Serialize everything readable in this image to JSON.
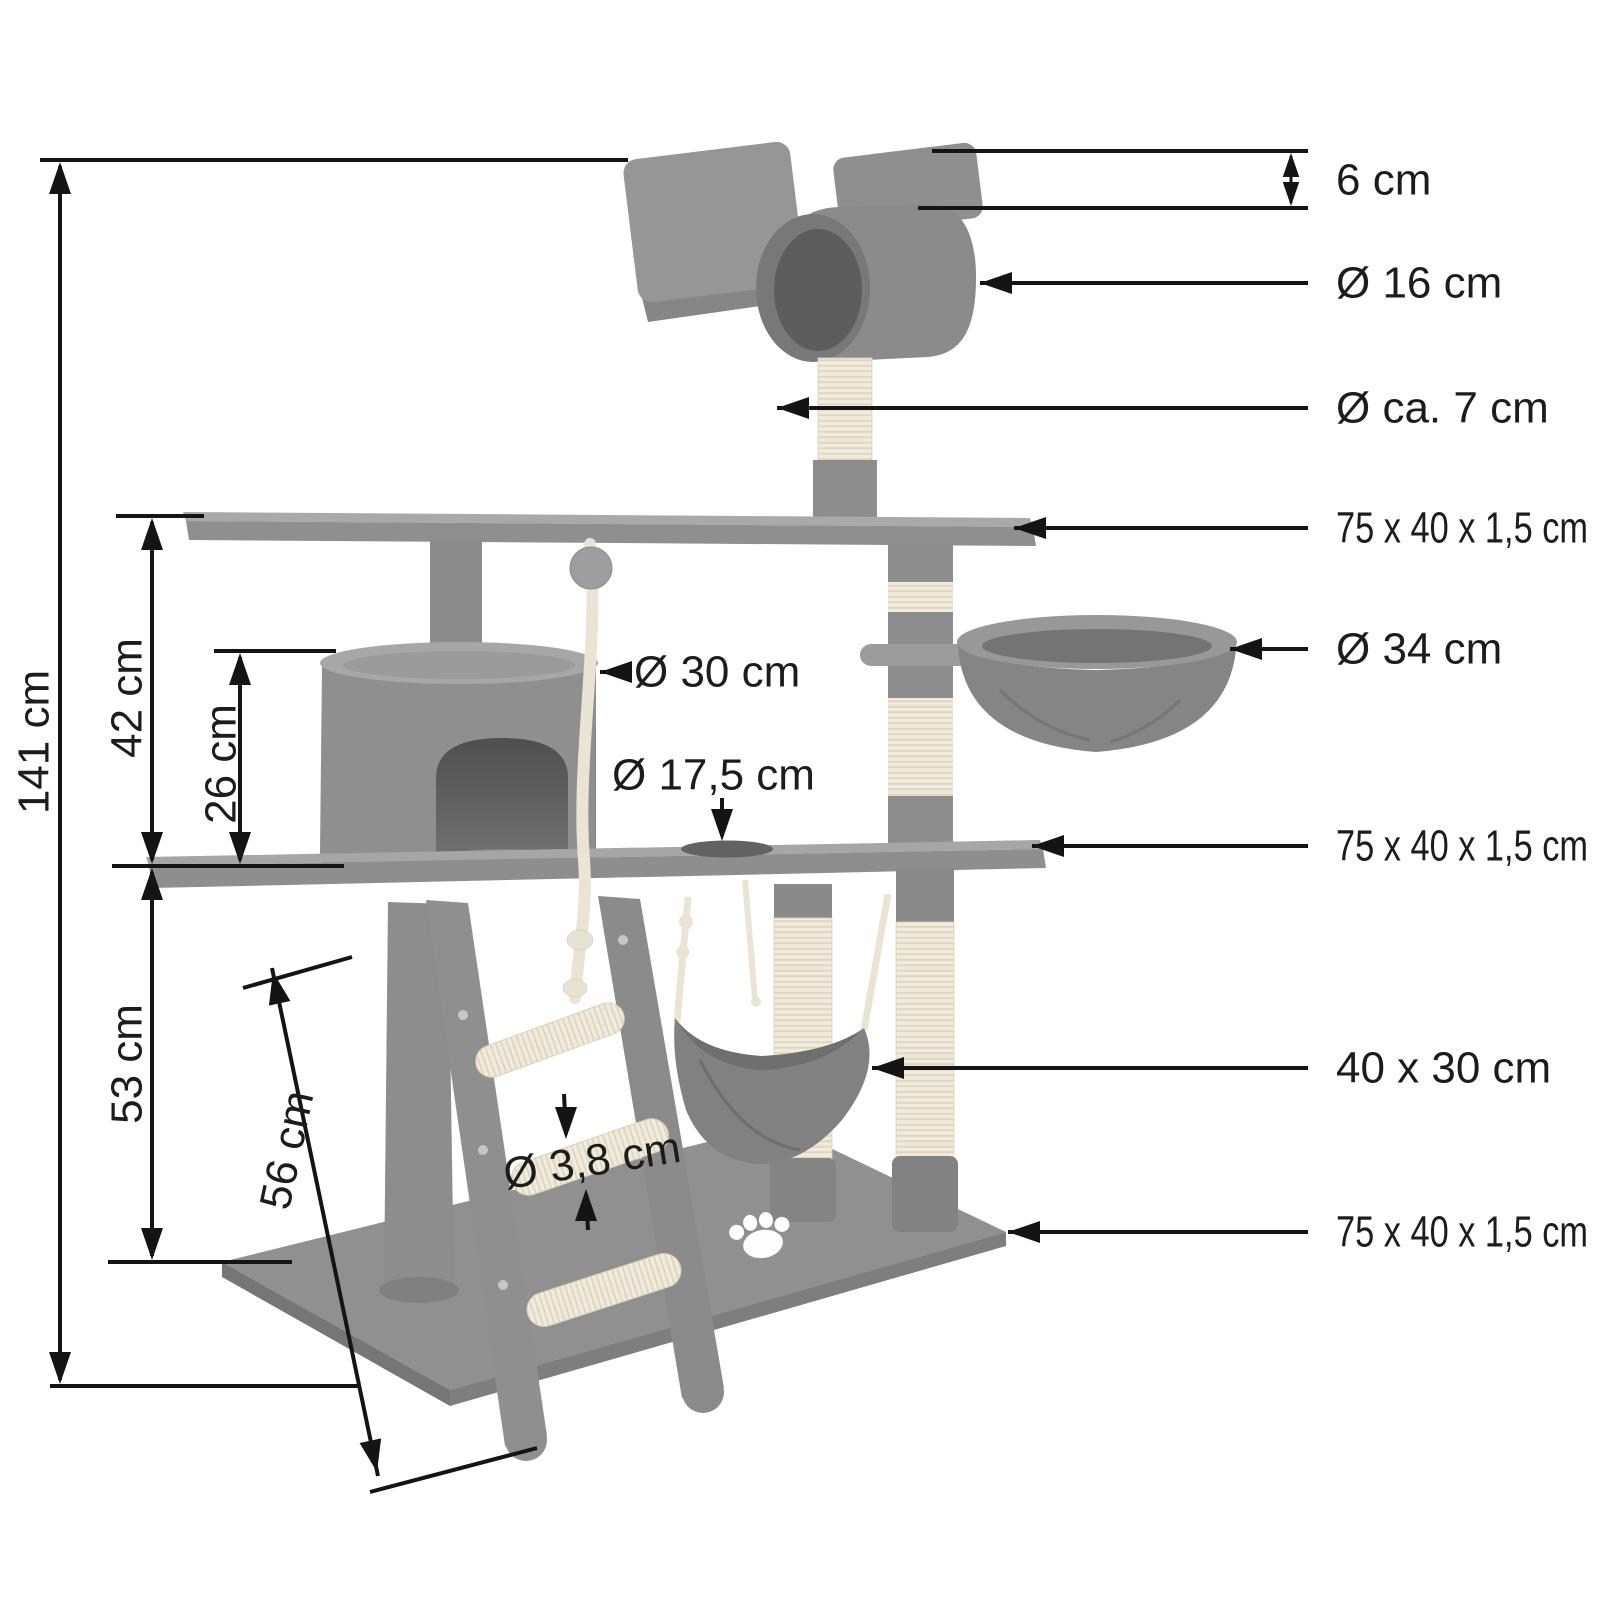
{
  "diagram": {
    "subject": "cat-scratching-tree-dimension-diagram",
    "labels": {
      "left": {
        "total_height": "141 cm",
        "upper_section_height": "42 cm",
        "house_height": "26 cm",
        "lower_section_height": "53 cm",
        "base_depth": "56 cm"
      },
      "right": {
        "top_platform_thickness": "6 cm",
        "tunnel_diameter": "Ø 16 cm",
        "post_diameter": "Ø ca. 7 cm",
        "top_shelf_size": "75 x 40 x 1,5 cm",
        "basket_diameter": "Ø 34 cm",
        "middle_shelf_size": "75 x 40 x 1,5 cm",
        "hammock_size": "40 x 30 cm",
        "base_board_size": "75 x 40 x 1,5 cm"
      },
      "inner": {
        "house_diameter": "Ø 30 cm",
        "hole_diameter": "Ø 17,5 cm",
        "rung_diameter": "Ø 3,8 cm"
      }
    },
    "colors": {
      "dimension_line": "#141414",
      "label_text": "#1c1c1c",
      "plush_gray": "#949494",
      "sisal_cream": "#efead9",
      "background": "#ffffff"
    }
  }
}
